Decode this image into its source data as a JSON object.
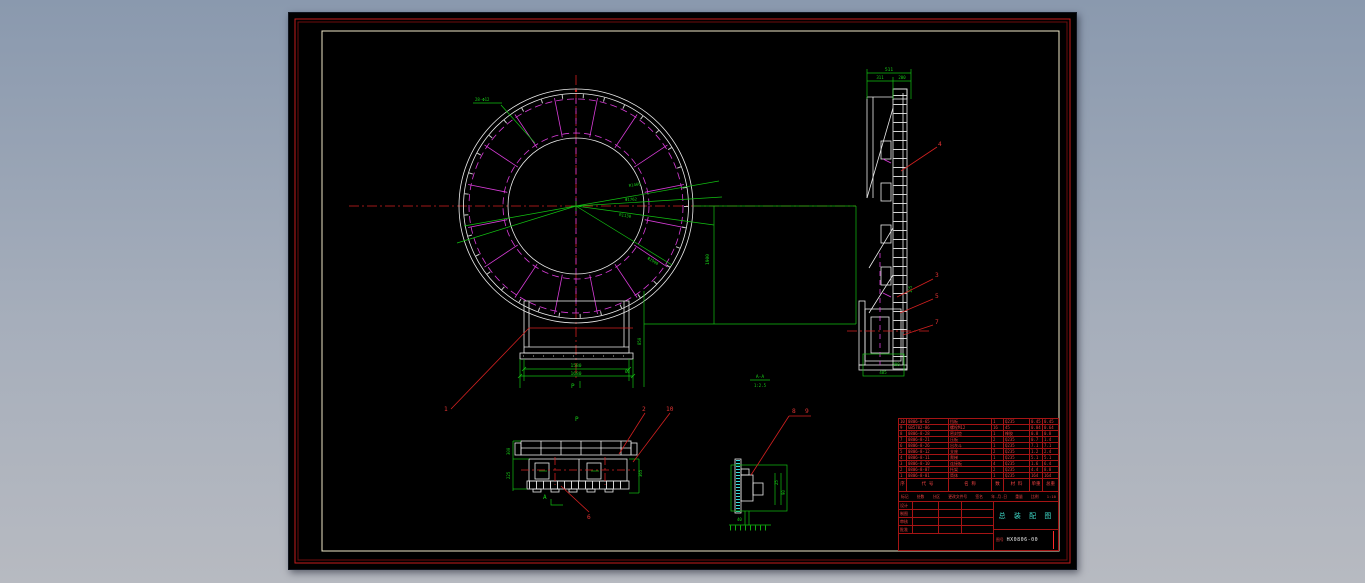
{
  "canvas": {
    "bg_top": "#8a99ae",
    "bg_bottom": "#b7bac1"
  },
  "sheet": {
    "bg": "#000000",
    "frame_red": "#c31c1c",
    "frame_red_dark": "#6e0d0d",
    "frame_inner": "#efe9c9"
  },
  "palette": {
    "line_white": "#ececec",
    "line_magenta": "#d93cd9",
    "line_green": "#12c112",
    "line_red": "#d42020",
    "hatch_cyan": "#35dede",
    "title_cyan": "#3fd9c8"
  },
  "front_view": {
    "hole_callout": "28-Φ12",
    "dim_r1": "R1460",
    "dim_d1": "Φ1762",
    "dim_r2": "R1130",
    "dim_od": "Φ2900",
    "dim_height": "1900",
    "dim_w_inner": "1580",
    "dim_w_outer": "1680",
    "dim_side": "850",
    "dim_flange": "60",
    "view_marker": "P",
    "balloon_1": "1"
  },
  "side_view": {
    "dim_total": "511",
    "dim_a": "311",
    "dim_b": "200",
    "dim_c": "125",
    "dim_base": "485",
    "dim_base_h": "200",
    "balloon_4": "4",
    "balloon_3": "3",
    "balloon_5": "5",
    "balloon_7": "7"
  },
  "section_view": {
    "view_label": "P",
    "dim_h1": "300",
    "dim_h2": "225",
    "dim_r": "365",
    "marker": "A",
    "balloon_2": "2",
    "balloon_10": "10",
    "balloon_6": "6"
  },
  "detail_view": {
    "title": "A-A",
    "scale": "1:2.5",
    "balloon_8": "8",
    "balloon_9": "9",
    "dim_1": "25",
    "dim_2": "90",
    "dim_3": "40"
  },
  "parts_table": {
    "headers": [
      "序",
      "代  号",
      "名  称",
      "数",
      "材 料",
      "单重",
      "总重"
    ],
    "rows": [
      {
        "no": "10",
        "code": "0806-8-65",
        "name": "挡板",
        "qty": "1",
        "mat": "Q235",
        "uw": "0.45",
        "tw": "0.45"
      },
      {
        "no": "9",
        "code": "GB5782-86",
        "name": "螺栓M12",
        "qty": "16",
        "mat": "45",
        "uw": "0.04",
        "tw": "0.64"
      },
      {
        "no": "8",
        "code": "0806-8-28",
        "name": "密封垫",
        "qty": "1",
        "mat": "橡胶",
        "uw": "0.8",
        "tw": "0.8"
      },
      {
        "no": "7",
        "code": "0806-8-21",
        "name": "压板",
        "qty": "2",
        "mat": "Q235",
        "uw": "0.7",
        "tw": "1.4"
      },
      {
        "no": "6",
        "code": "0806-8-26",
        "name": "出灰斗",
        "qty": "1",
        "mat": "Q235",
        "uw": "7.1",
        "tw": "7.1"
      },
      {
        "no": "5",
        "code": "0806-8-12",
        "name": "支座",
        "qty": "2",
        "mat": "Q235",
        "uw": "1.2",
        "tw": "2.4"
      },
      {
        "no": "4",
        "code": "0806-8-11",
        "name": "爬梯",
        "qty": "1",
        "mat": "Q235",
        "uw": "5.1",
        "tw": "5.1"
      },
      {
        "no": "3",
        "code": "0806-8-10",
        "name": "连接板",
        "qty": "4",
        "mat": "Q235",
        "uw": "1.6",
        "tw": "6.4"
      },
      {
        "no": "2",
        "code": "0806-8-07",
        "name": "托架",
        "qty": "2",
        "mat": "Q235",
        "uw": "4.4",
        "tw": "8.8"
      },
      {
        "no": "1",
        "code": "0806-8-01",
        "name": "筒体",
        "qty": "1",
        "mat": "Q235",
        "uw": "164",
        "tw": "164"
      }
    ],
    "footer_items": [
      "标记",
      "处数",
      "分区",
      "更改文件号",
      "签名",
      "年.月.日",
      "重量",
      "比例",
      "1:10"
    ]
  },
  "title_block": {
    "rows": [
      {
        "a": "设计",
        "b": "",
        "c": ""
      },
      {
        "a": "制图",
        "b": "",
        "c": ""
      },
      {
        "a": "审核",
        "b": "",
        "c": ""
      },
      {
        "a": "批准",
        "b": "",
        "c": ""
      }
    ],
    "title": "总 装 配 图",
    "label_no": "图号",
    "drawing_no": "HX0806-00"
  }
}
